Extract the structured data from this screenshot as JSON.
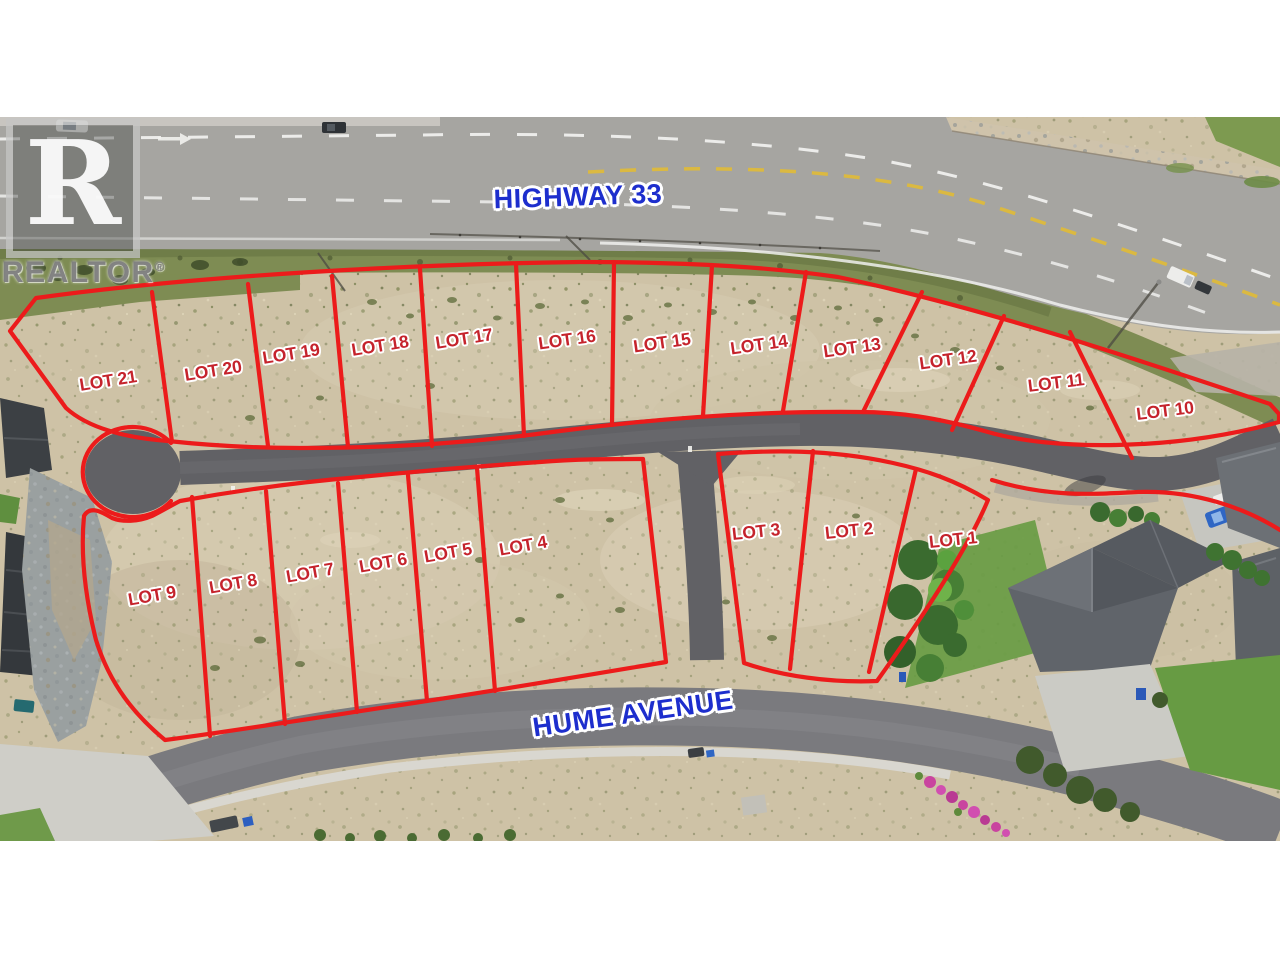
{
  "watermark": {
    "logo_letter": "R",
    "brand": "REALTOR",
    "registered_mark": "®"
  },
  "street_labels": {
    "highway": "HIGHWAY 33",
    "avenue": "HUME AVENUE"
  },
  "lot_labels": {
    "upper_row": [
      "LOT 21",
      "LOT 20",
      "LOT 19",
      "LOT 18",
      "LOT 17",
      "LOT 16",
      "LOT 15",
      "LOT 14",
      "LOT 13",
      "LOT 12",
      "LOT 11",
      "LOT 10"
    ],
    "lower_west_block": [
      "LOT 9",
      "LOT 8",
      "LOT 7",
      "LOT 6",
      "LOT 5",
      "LOT 4"
    ],
    "lower_east_block": [
      "LOT 3",
      "LOT 2",
      "LOT 1"
    ]
  },
  "colors": {
    "boundary_red": "#ec1b1b",
    "lot_label_red": "#c5232c",
    "street_label_blue": "#1d2ecd",
    "label_outline_white": "#ffffff"
  }
}
